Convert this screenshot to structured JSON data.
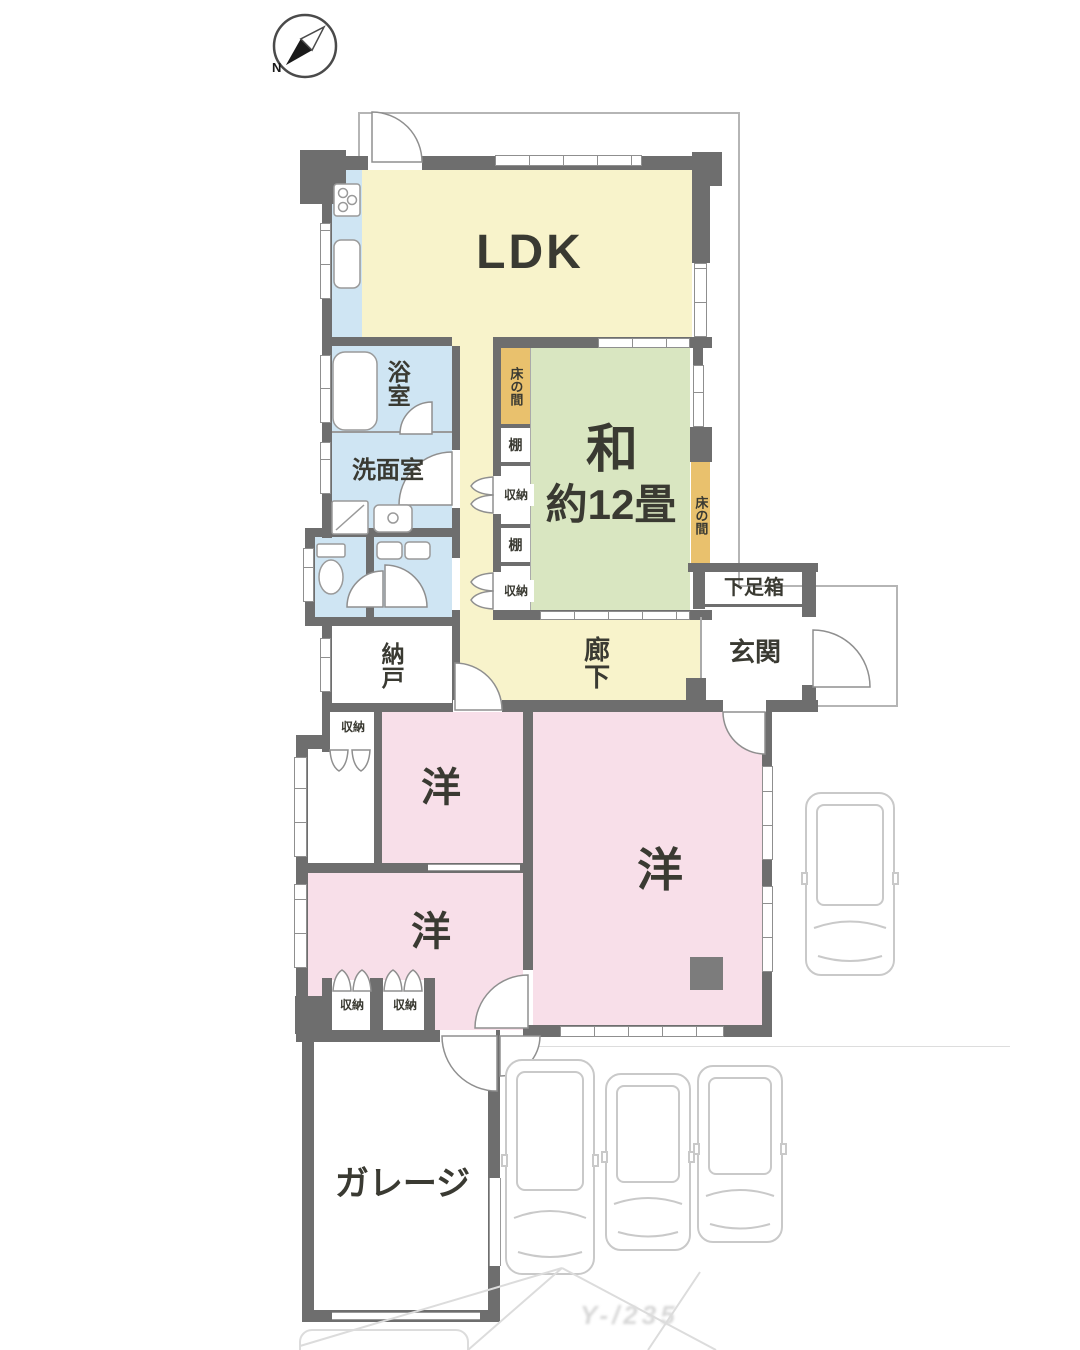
{
  "compass": {
    "north_label": "N"
  },
  "labels": {
    "ldk": "LDK",
    "bathroom": "浴室",
    "washroom": "洗面室",
    "japanese_room_name": "和",
    "japanese_room_size": "約12畳",
    "tokonoma": "床の間",
    "shelf": "棚",
    "storage": "収納",
    "shoe_box": "下足箱",
    "entrance": "玄関",
    "storeroom": "納戸",
    "corridor": "廊下",
    "western_room": "洋",
    "garage": "ガレージ"
  },
  "colors": {
    "wall": "#6e6e6e",
    "ldk_corridor_fill": "#f8f3cb",
    "japanese_room_fill": "#d9e6c1",
    "western_room_fill": "#f8dfe9",
    "wet_area_fill": "#cfe5f3",
    "tokonoma_fill": "#e9c16d",
    "outline": "#b5b5b5"
  },
  "watermark": "Y-/235"
}
